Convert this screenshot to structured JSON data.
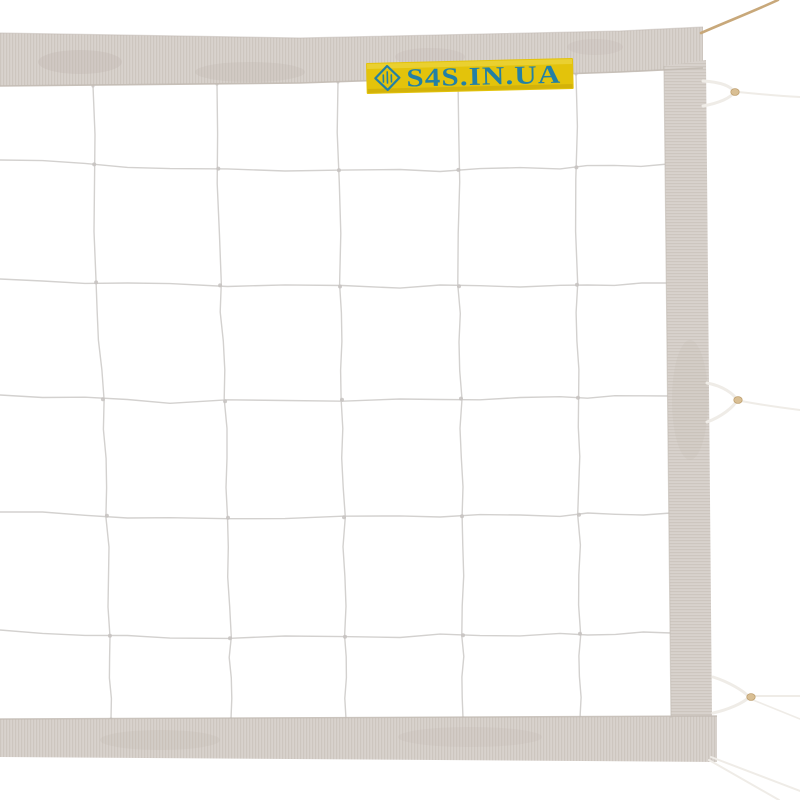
{
  "meta": {
    "type": "product-photo",
    "subject": "White volleyball net with fabric edge tapes, cord mesh, side attachment loops and suspension rope"
  },
  "label": {
    "text": "S4S.IN.UA",
    "background": "#e3c30b",
    "foreground": "#2380a5",
    "highlight": "#f2dd55",
    "shade": "#8a6a00",
    "logo": "s4s-diamond-logo"
  },
  "palette": {
    "background": "#ffffff",
    "tape": "#d8d2cd",
    "tape_rib": "#c9c1bb",
    "tape_edge": "#c2bab3",
    "tape_shade": "#bdb3ab",
    "net_line": "#d3d1cf",
    "net_knot": "#c6c2bf",
    "cord": "#efece7",
    "rope": "#c8a87a",
    "bead": "#d9bf94",
    "bead_edge": "#bfa070"
  },
  "geometry": {
    "top_tape": [
      [
        0,
        33
      ],
      [
        300,
        38
      ],
      [
        620,
        31
      ],
      [
        703,
        27
      ],
      [
        703,
        68
      ],
      [
        620,
        72
      ],
      [
        300,
        83
      ],
      [
        0,
        86
      ]
    ],
    "side_tape": [
      [
        664,
        66
      ],
      [
        706,
        60
      ],
      [
        712,
        717
      ],
      [
        671,
        718
      ]
    ],
    "bottom_tape": [
      [
        0,
        719
      ],
      [
        717,
        716
      ],
      [
        717,
        762
      ],
      [
        0,
        757
      ]
    ],
    "tape_blotches": [
      [
        80,
        62,
        42,
        12,
        0.3
      ],
      [
        250,
        72,
        55,
        10,
        0.25
      ],
      [
        430,
        57,
        35,
        9,
        0.22
      ],
      [
        595,
        47,
        28,
        8,
        0.22
      ],
      [
        160,
        740,
        60,
        10,
        0.2
      ],
      [
        470,
        737,
        72,
        10,
        0.18
      ],
      [
        690,
        400,
        18,
        60,
        0.15
      ]
    ],
    "net": {
      "verticals": [
        [
          [
            93,
            86
          ],
          [
            96,
            280
          ],
          [
            103,
            400
          ],
          [
            107,
            517
          ],
          [
            110,
            637
          ],
          [
            111,
            719
          ]
        ],
        [
          [
            217,
            84
          ],
          [
            220,
            283
          ],
          [
            225,
            399
          ],
          [
            228,
            517
          ],
          [
            230,
            637
          ],
          [
            231,
            719
          ]
        ],
        [
          [
            338,
            82
          ],
          [
            340,
            284
          ],
          [
            342,
            399
          ],
          [
            344,
            517
          ],
          [
            345,
            636
          ],
          [
            346,
            719
          ]
        ],
        [
          [
            458,
            79
          ],
          [
            459,
            285
          ],
          [
            461,
            399
          ],
          [
            462,
            516
          ],
          [
            463,
            636
          ],
          [
            463,
            718
          ]
        ],
        [
          [
            576,
            74
          ],
          [
            577,
            284
          ],
          [
            578,
            398
          ],
          [
            579,
            515
          ],
          [
            580,
            635
          ],
          [
            580,
            718
          ]
        ]
      ],
      "horizontals": [
        [
          [
            0,
            160
          ],
          [
            170,
            168
          ],
          [
            400,
            171
          ],
          [
            560,
            168
          ],
          [
            668,
            164
          ]
        ],
        [
          [
            0,
            279
          ],
          [
            170,
            285
          ],
          [
            400,
            287
          ],
          [
            560,
            285
          ],
          [
            669,
            283
          ]
        ],
        [
          [
            0,
            395
          ],
          [
            170,
            402
          ],
          [
            400,
            399
          ],
          [
            560,
            398
          ],
          [
            670,
            396
          ]
        ],
        [
          [
            0,
            512
          ],
          [
            170,
            518
          ],
          [
            400,
            517
          ],
          [
            560,
            515
          ],
          [
            671,
            513
          ]
        ],
        [
          [
            0,
            630
          ],
          [
            170,
            639
          ],
          [
            400,
            636
          ],
          [
            560,
            634
          ],
          [
            671,
            633
          ]
        ]
      ]
    },
    "attachments": [
      {
        "name": "top-loop",
        "cord": "M703,81 C720,82 731,86 734,92 C731,98 719,103 703,106",
        "bead": [
          735,
          92
        ],
        "strings": [
          [
            "M738,92 C758,94 782,96 800,97",
            2
          ]
        ]
      },
      {
        "name": "middle-loop",
        "cord": "M707,383 C723,386 734,394 737,400 C734,407 721,417 707,422",
        "bead": [
          738,
          400
        ],
        "strings": [
          [
            "M741,401 C762,405 784,408 800,410",
            2
          ]
        ]
      },
      {
        "name": "bottom-loop",
        "cord": "M713,677 C729,682 744,691 749,697 C744,703 727,710 713,713",
        "bead": [
          751,
          697
        ],
        "strings": [
          [
            "M754,696 C770,696 788,696 800,696",
            2
          ],
          [
            "M753,700 L800,719",
            1.6
          ]
        ]
      },
      {
        "name": "corner-strings",
        "cord": "",
        "bead": null,
        "strings": [
          [
            "M711,757 L800,791",
            2
          ],
          [
            "M709,760 L779,800",
            2
          ]
        ]
      }
    ],
    "rope": {
      "path": "M701,33 C726,22 752,12 778,0",
      "width": 2.6
    },
    "label_pos": {
      "x": 366,
      "y": 63,
      "w": 207,
      "h": 31,
      "rotate": -1.4
    }
  }
}
